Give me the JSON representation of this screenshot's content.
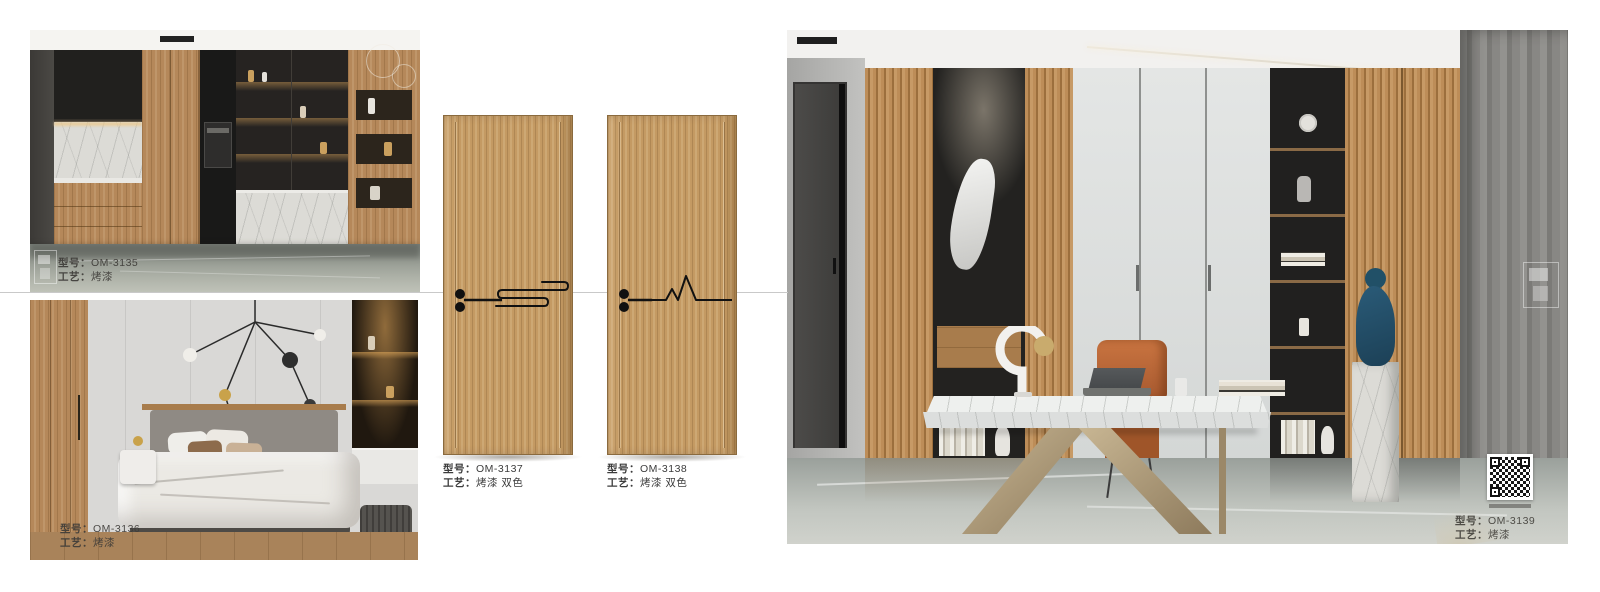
{
  "page_type": "product-catalog-page",
  "keys": {
    "model": "型号：",
    "process": "工艺："
  },
  "products": {
    "kitchen": {
      "model": "OM-3135",
      "process": "烤漆"
    },
    "bedroom": {
      "model": "OM-3136",
      "process": "烤漆"
    },
    "doorA": {
      "model": "OM-3137",
      "process": "烤漆 双色"
    },
    "doorB": {
      "model": "OM-3138",
      "process": "烤漆 双色"
    },
    "study": {
      "model": "OM-3139",
      "process": "烤漆"
    }
  },
  "icons": {
    "qr_code": "qr-code",
    "brand_watermark": "brand-logo-watermark"
  },
  "colors": {
    "wood": "#b5885a",
    "door_wood": "#c49a63",
    "accent_gold": "#b7a489",
    "chair_orange": "#bf6a3c",
    "statue_blue": "#235775",
    "divider_grey": "#c9c9c9"
  }
}
